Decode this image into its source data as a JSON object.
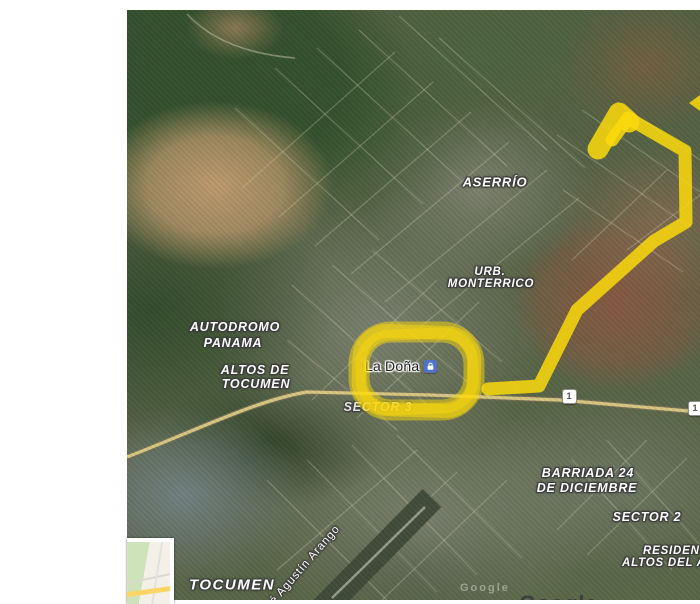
{
  "map": {
    "type": "google-maps-satellite-view",
    "annotation_color": "#fbd90c",
    "poi": {
      "name": "La Doña",
      "icon": "shopping-bag-icon",
      "icon_color": "#4e73c8"
    },
    "labels": [
      {
        "id": "aserrio",
        "text": "ASERRÍO",
        "x": 368,
        "y": 172,
        "size": 13
      },
      {
        "id": "urb-line1",
        "text": "URB.",
        "x": 363,
        "y": 262,
        "size": 11.5
      },
      {
        "id": "urb-line2",
        "text": "MONTERRICO",
        "x": 364,
        "y": 274,
        "size": 11.5
      },
      {
        "id": "autodromo-line1",
        "text": "AUTODROMO",
        "x": 108,
        "y": 317,
        "size": 12.5
      },
      {
        "id": "autodromo-line2",
        "text": "PANAMA",
        "x": 106,
        "y": 333,
        "size": 12.5
      },
      {
        "id": "altos-tocumen-line1",
        "text": "ALTOS DE",
        "x": 128,
        "y": 360,
        "size": 12.5
      },
      {
        "id": "altos-tocumen-line2",
        "text": "TOCUMEN",
        "x": 129,
        "y": 374,
        "size": 12.5
      },
      {
        "id": "sector-3",
        "text": "SECTOR 3",
        "x": 251,
        "y": 397,
        "size": 12.5,
        "opacity": 0.85
      },
      {
        "id": "barriada-line1",
        "text": "BARRIADA 24",
        "x": 461,
        "y": 463,
        "size": 12.5
      },
      {
        "id": "barriada-line2",
        "text": "DE DICIEMBRE",
        "x": 460,
        "y": 478,
        "size": 12.5
      },
      {
        "id": "sector-2",
        "text": "SECTOR 2",
        "x": 520,
        "y": 507,
        "size": 12.5
      },
      {
        "id": "residencial-line1",
        "text": "RESIDENC",
        "x": 516,
        "y": 541,
        "size": 11.5,
        "anchor": "left"
      },
      {
        "id": "residencial-line2",
        "text": "ALTOS DEL A",
        "x": 495,
        "y": 553,
        "size": 11.5,
        "anchor": "left"
      },
      {
        "id": "tocumen",
        "text": "TOCUMEN",
        "x": 105,
        "y": 575,
        "size": 15,
        "spacing": 1.5
      },
      {
        "id": "street-agustin-arango",
        "text": "é Agustín Arango",
        "x": 178,
        "y": 555,
        "size": 11.5,
        "rotate": -49,
        "weight": 400,
        "italic": false
      }
    ],
    "route_shields": [
      {
        "label": "1",
        "x": 442,
        "y": 386
      },
      {
        "label": "1",
        "x": 568,
        "y": 398
      }
    ],
    "watermark_small": "Google",
    "logo": "Google"
  }
}
